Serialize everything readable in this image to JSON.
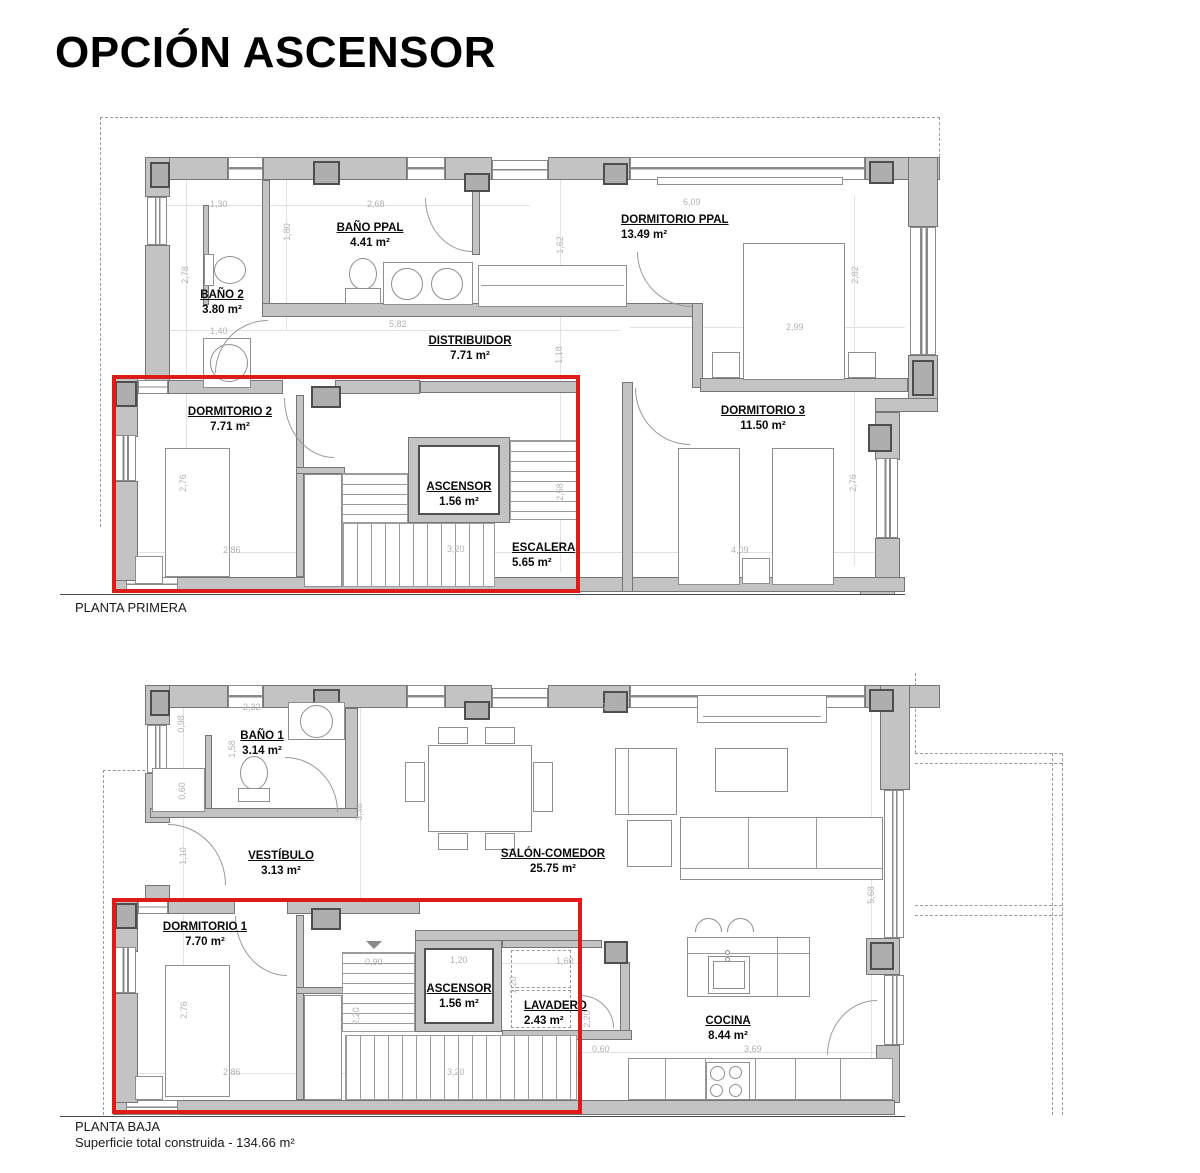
{
  "title": "OPCIÓN ASCENSOR",
  "highlight_color": "#df1a1a",
  "wall_color": "#c3c3c3",
  "floors": [
    {
      "caption": "PLANTA PRIMERA",
      "rooms": [
        {
          "name": "BAÑO 2",
          "area": "3.80 m²"
        },
        {
          "name": "BAÑO PPAL",
          "area": "4.41 m²"
        },
        {
          "name": "DORMITORIO PPAL",
          "area": "13.49 m²"
        },
        {
          "name": "DISTRIBUIDOR",
          "area": "7.71 m²"
        },
        {
          "name": "DORMITORIO 2",
          "area": "7.71 m²"
        },
        {
          "name": "ASCENSOR",
          "area": "1.56 m²"
        },
        {
          "name": "ESCALERA",
          "area": "5.65 m²"
        },
        {
          "name": "DORMITORIO 3",
          "area": "11.50 m²"
        }
      ],
      "dims": [
        "1,30",
        "2,68",
        "1,80",
        "2,78",
        "1,40",
        "5,82",
        "1,62",
        "1,18",
        "6,09",
        "2,82",
        "2,99",
        "2,76",
        "2,86",
        "3,20",
        "2,58",
        "4,09",
        "2,76"
      ]
    },
    {
      "caption": "PLANTA BAJA",
      "subcaption": "Superficie total construida - 134.66 m²",
      "rooms": [
        {
          "name": "BAÑO 1",
          "area": "3.14 m²"
        },
        {
          "name": "VESTÍBULO",
          "area": "3.13 m²"
        },
        {
          "name": "SALÓN-COMEDOR",
          "area": "25.75 m²"
        },
        {
          "name": "DORMITORIO 1",
          "area": "7.70 m²"
        },
        {
          "name": "ASCENSOR",
          "area": "1.56 m²"
        },
        {
          "name": "LAVADERO",
          "area": "2.43 m²"
        },
        {
          "name": "COCINA",
          "area": "8.44 m²"
        }
      ],
      "dims": [
        "2,32",
        "0,98",
        "1,58",
        "0,60",
        "1,10",
        "3,38",
        "7,59",
        "5,68",
        "0,90",
        "1,20",
        "1,60",
        "1,20",
        "2,20",
        "2,76",
        "2,86",
        "3,20",
        "2,20",
        "0,60",
        "3,69"
      ]
    }
  ]
}
